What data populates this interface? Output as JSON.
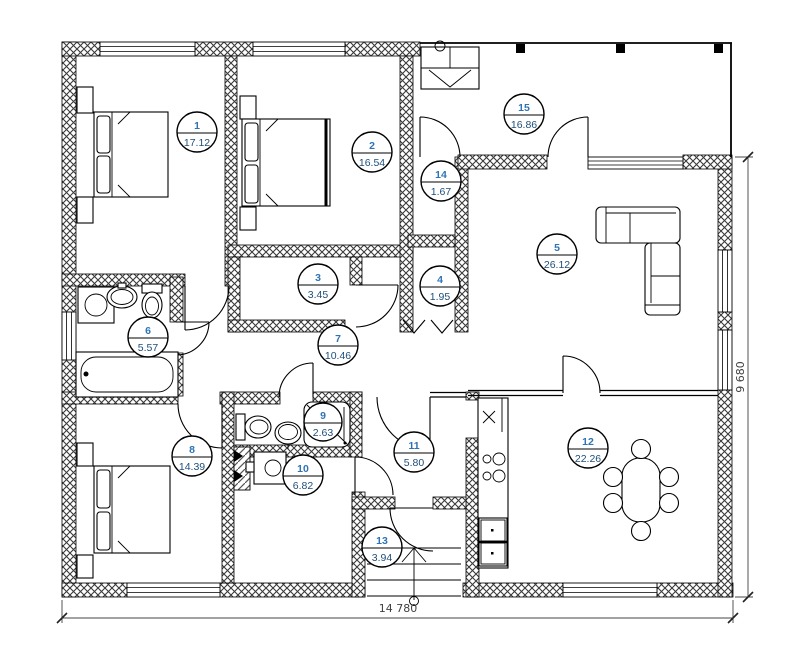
{
  "title": "house-floor-plan",
  "rooms": [
    {
      "number": "1",
      "area": "17.12"
    },
    {
      "number": "2",
      "area": "16.54"
    },
    {
      "number": "3",
      "area": "3.45"
    },
    {
      "number": "4",
      "area": "1.95"
    },
    {
      "number": "5",
      "area": "26.12"
    },
    {
      "number": "6",
      "area": "5.57"
    },
    {
      "number": "7",
      "area": "10.46"
    },
    {
      "number": "8",
      "area": "14.39"
    },
    {
      "number": "9",
      "area": "2.63"
    },
    {
      "number": "10",
      "area": "6.82"
    },
    {
      "number": "11",
      "area": "5.80"
    },
    {
      "number": "12",
      "area": "22.26"
    },
    {
      "number": "13",
      "area": "3.94"
    },
    {
      "number": "14",
      "area": "1.67"
    },
    {
      "number": "15",
      "area": "16.86"
    }
  ],
  "dimensions": {
    "width": "14 780",
    "height": "9 680"
  },
  "colors": {
    "room_number": "#2e74b5",
    "room_area": "#1f4e79",
    "dimension_text": "#3f3f3f",
    "wall_line": "#000000"
  }
}
